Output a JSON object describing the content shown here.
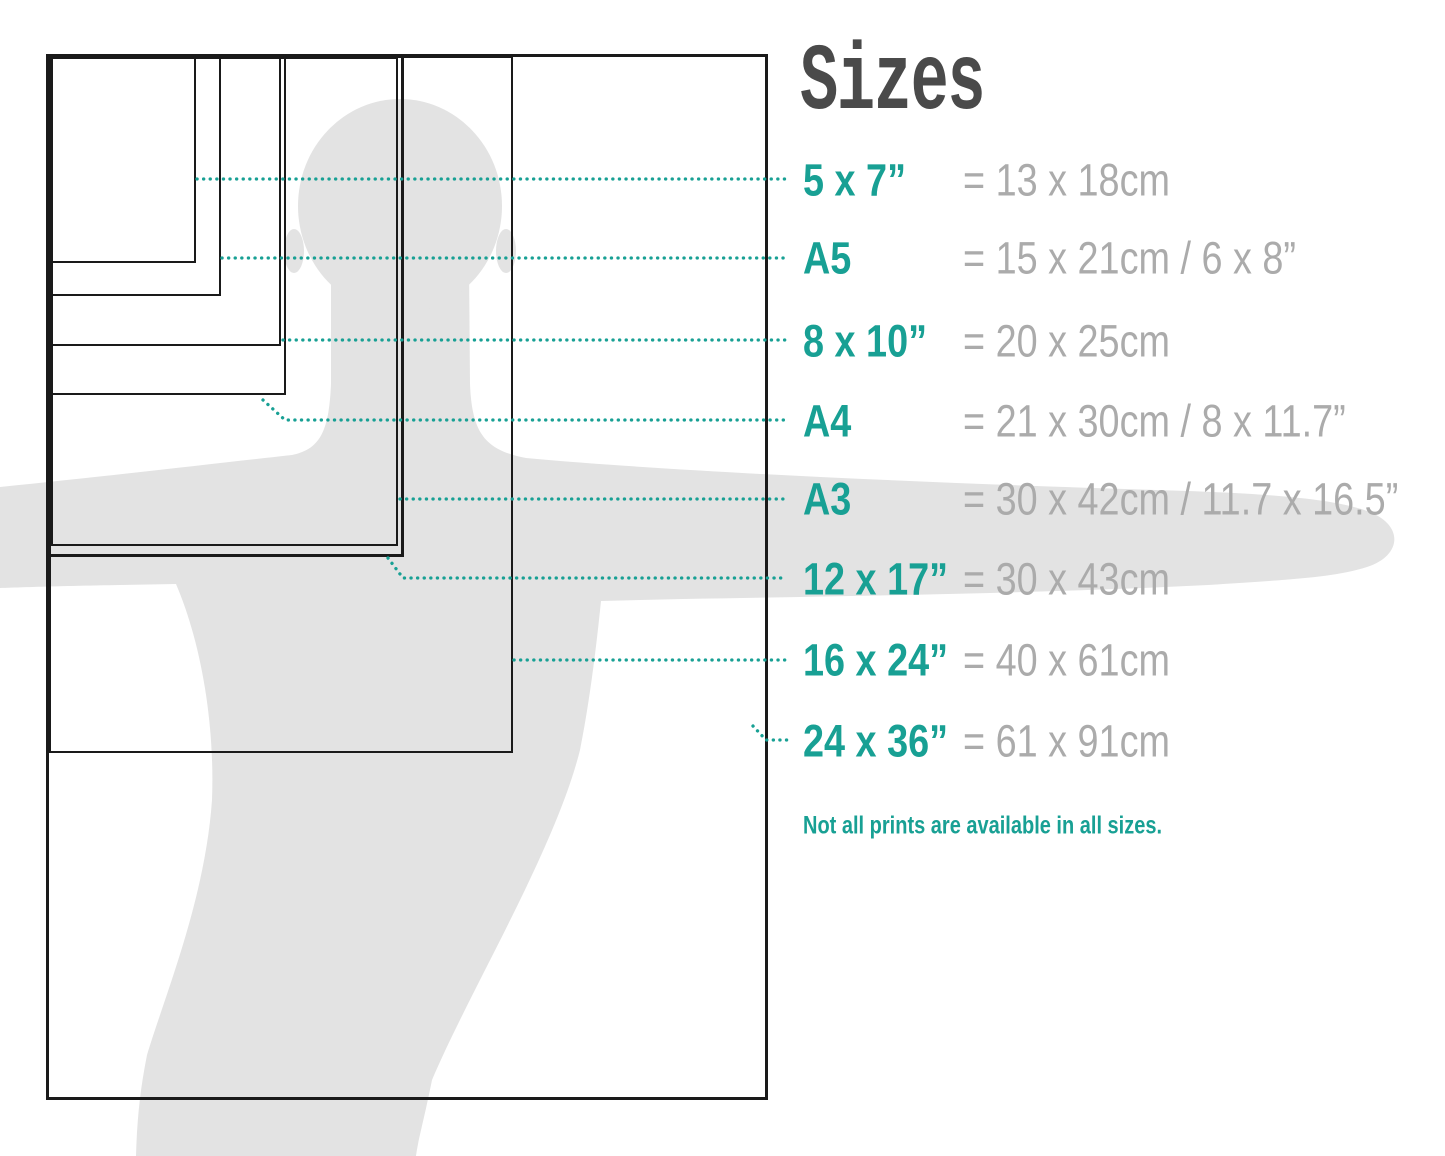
{
  "title": "Sizes",
  "note": "Not all prints are available in all sizes.",
  "colors": {
    "accent": "#18A094",
    "value_gray": "#ABABAB",
    "title_gray": "#4A4A4A",
    "line_black": "#1A1A1A",
    "silhouette_gray": "#E3E3E3"
  },
  "sizes": [
    {
      "id": "5x7",
      "label": "5 x 7”",
      "value": "= 13 x 18cm",
      "row_y": 180,
      "pointer": [
        [
          197,
          179
        ],
        [
          786,
          179
        ]
      ],
      "rect": {
        "left": 51,
        "top": 57,
        "width": 145,
        "height": 206,
        "stroke": 2
      }
    },
    {
      "id": "a5",
      "label": "A5",
      "value": "= 15 x 21cm / 6 x 8”",
      "row_y": 258,
      "pointer": [
        [
          222,
          258
        ],
        [
          786,
          258
        ]
      ],
      "rect": {
        "left": 51,
        "top": 57,
        "width": 170,
        "height": 239,
        "stroke": 2
      }
    },
    {
      "id": "8x10",
      "label": "8 x 10”",
      "value": "= 20 x 25cm",
      "row_y": 341,
      "pointer": [
        [
          283,
          340
        ],
        [
          786,
          340
        ]
      ],
      "rect": {
        "left": 51,
        "top": 57,
        "width": 230,
        "height": 289,
        "stroke": 2
      }
    },
    {
      "id": "a4",
      "label": "A4",
      "value": "= 21 x 30cm / 8 x 11.7”",
      "row_y": 421,
      "pointer": [
        [
          263,
          400
        ],
        [
          285,
          420
        ],
        [
          786,
          420
        ]
      ],
      "rect": {
        "left": 51,
        "top": 57,
        "width": 235,
        "height": 338,
        "stroke": 2
      }
    },
    {
      "id": "a3",
      "label": "A3",
      "value": "= 30 x 42cm / 11.7 x 16.5”",
      "row_y": 499,
      "pointer": [
        [
          400,
          499
        ],
        [
          786,
          499
        ]
      ],
      "rect": {
        "left": 51,
        "top": 57,
        "width": 347,
        "height": 489,
        "stroke": 2
      }
    },
    {
      "id": "12x17",
      "label": "12 x 17”",
      "value": "= 30 x 43cm",
      "row_y": 579,
      "pointer": [
        [
          388,
          558
        ],
        [
          403,
          578
        ],
        [
          786,
          578
        ]
      ],
      "rect": {
        "left": 47,
        "top": 54,
        "width": 357,
        "height": 503,
        "stroke": 3
      }
    },
    {
      "id": "16x24",
      "label": "16 x 24”",
      "value": "= 40 x 61cm",
      "row_y": 660,
      "pointer": [
        [
          514,
          660
        ],
        [
          786,
          660
        ]
      ],
      "rect": {
        "left": 49,
        "top": 56,
        "width": 464,
        "height": 697,
        "stroke": 2
      }
    },
    {
      "id": "24x36",
      "label": "24 x 36”",
      "value": "= 61 x 91cm",
      "row_y": 741,
      "pointer": [
        [
          753,
          726
        ],
        [
          766,
          740
        ],
        [
          791,
          740
        ]
      ],
      "rect": {
        "left": 46,
        "top": 54,
        "width": 722,
        "height": 1046,
        "stroke": 3
      }
    }
  ]
}
